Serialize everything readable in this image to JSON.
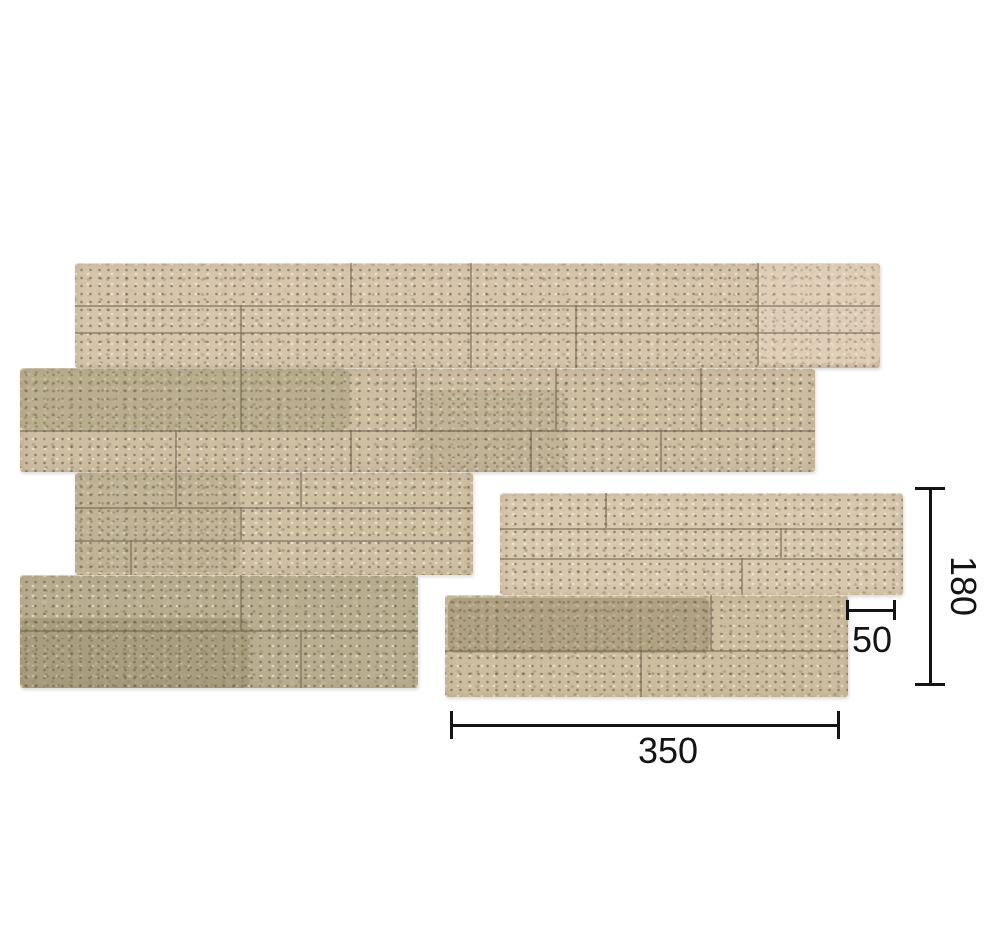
{
  "page": {
    "background": "#ffffff",
    "dimension_line_color": "#141414",
    "description_labels": {
      "assembly": "stone-panel-assembly",
      "single": "stone-panel-single"
    }
  },
  "dimensions": {
    "height": {
      "label": "180"
    },
    "notch": {
      "label": "50"
    },
    "width": {
      "label": "350"
    }
  },
  "palette": {
    "stone_light": "#d6c5ab",
    "stone_tan": "#cdbda1",
    "stone_beige": "#cfc0a4",
    "stone_olive": "#b9ad8f",
    "stone_pink_light": "#d8c8ae",
    "stone_warm_tan": "#cdbd9f",
    "mortar_joint": "rgba(116,104,84,0.55)"
  },
  "panels": [
    {
      "name": "stone-panel-assembly",
      "sections": [
        {
          "x": 75,
          "y": 263,
          "w": 805,
          "h": 105,
          "bg": "#d6c5ab"
        },
        {
          "x": 20,
          "y": 368,
          "w": 795,
          "h": 104,
          "bg": "#cdbda1"
        },
        {
          "x": 75,
          "y": 472,
          "w": 398,
          "h": 103,
          "bg": "#cfc0a4"
        },
        {
          "x": 20,
          "y": 575,
          "w": 398,
          "h": 113,
          "bg": "#b9ad8f"
        }
      ],
      "patches": [
        {
          "x": 20,
          "y": 368,
          "w": 330,
          "h": 62,
          "c": "rgba(150,142,106,0.35)"
        },
        {
          "x": 415,
          "y": 390,
          "w": 150,
          "h": 82,
          "c": "rgba(152,144,108,0.22)"
        },
        {
          "x": 75,
          "y": 472,
          "w": 165,
          "h": 100,
          "c": "rgba(150,142,106,0.25)"
        },
        {
          "x": 20,
          "y": 618,
          "w": 230,
          "h": 70,
          "c": "rgba(125,115,80,0.28)"
        },
        {
          "x": 757,
          "y": 263,
          "w": 123,
          "h": 100,
          "c": "rgba(238,218,198,0.45)"
        }
      ],
      "joints_h": [
        {
          "y": 305,
          "x": 75,
          "w": 805
        },
        {
          "y": 332,
          "x": 75,
          "w": 805
        },
        {
          "y": 430,
          "x": 20,
          "w": 795
        },
        {
          "y": 507,
          "x": 75,
          "w": 398
        },
        {
          "y": 540,
          "x": 75,
          "w": 398
        },
        {
          "y": 630,
          "x": 20,
          "w": 398
        }
      ],
      "joints_v": [
        {
          "x": 350,
          "y": 263,
          "h": 42
        },
        {
          "x": 470,
          "y": 263,
          "h": 105
        },
        {
          "x": 575,
          "y": 305,
          "h": 63
        },
        {
          "x": 757,
          "y": 263,
          "h": 102
        },
        {
          "x": 240,
          "y": 305,
          "h": 63
        },
        {
          "x": 240,
          "y": 368,
          "h": 62
        },
        {
          "x": 415,
          "y": 368,
          "h": 62
        },
        {
          "x": 555,
          "y": 368,
          "h": 62
        },
        {
          "x": 700,
          "y": 368,
          "h": 62
        },
        {
          "x": 175,
          "y": 430,
          "h": 42
        },
        {
          "x": 350,
          "y": 430,
          "h": 42
        },
        {
          "x": 530,
          "y": 430,
          "h": 42
        },
        {
          "x": 660,
          "y": 430,
          "h": 42
        },
        {
          "x": 175,
          "y": 472,
          "h": 35
        },
        {
          "x": 300,
          "y": 472,
          "h": 35
        },
        {
          "x": 240,
          "y": 507,
          "h": 33
        },
        {
          "x": 130,
          "y": 540,
          "h": 35
        },
        {
          "x": 240,
          "y": 575,
          "h": 55
        },
        {
          "x": 300,
          "y": 630,
          "h": 58
        }
      ]
    },
    {
      "name": "stone-panel-single",
      "sections": [
        {
          "x": 500,
          "y": 493,
          "w": 403,
          "h": 102,
          "bg": "#d8c8ae"
        },
        {
          "x": 445,
          "y": 595,
          "w": 403,
          "h": 102,
          "bg": "#cdbd9f"
        }
      ],
      "patches": [
        {
          "x": 448,
          "y": 598,
          "w": 262,
          "h": 55,
          "c": "rgba(128,118,82,0.38)"
        }
      ],
      "joints_h": [
        {
          "y": 528,
          "x": 500,
          "w": 403
        },
        {
          "y": 558,
          "x": 500,
          "w": 403
        },
        {
          "y": 650,
          "x": 445,
          "w": 403
        }
      ],
      "joints_v": [
        {
          "x": 605,
          "y": 493,
          "h": 35
        },
        {
          "x": 780,
          "y": 528,
          "h": 30
        },
        {
          "x": 741,
          "y": 558,
          "h": 37
        },
        {
          "x": 710,
          "y": 595,
          "h": 55
        },
        {
          "x": 640,
          "y": 650,
          "h": 47
        }
      ]
    }
  ]
}
